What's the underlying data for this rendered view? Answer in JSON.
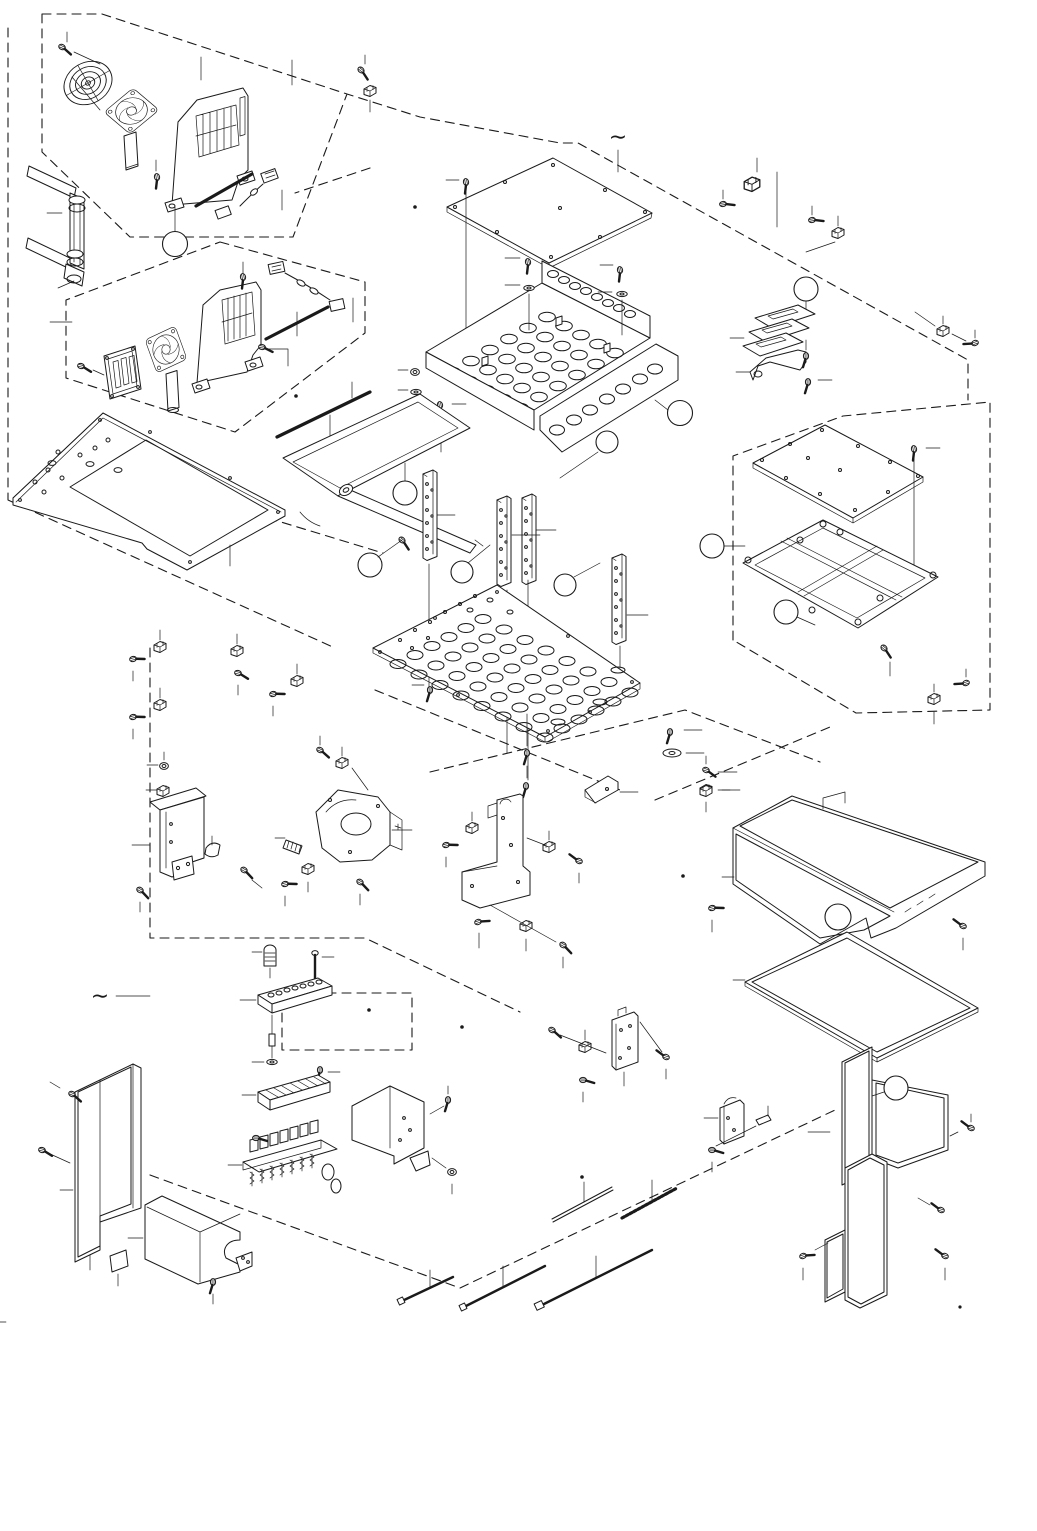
{
  "figure": {
    "type": "exploded-parts-diagram",
    "projection": "isometric",
    "background_color": "#ffffff",
    "line_color": "#1a1a1a",
    "page_width_px": 1037,
    "page_height_px": 1531
  },
  "symbols": {
    "continuation_mark": "∼",
    "continuation_mark_count": 2
  },
  "callouts": {
    "shape": "empty-circle",
    "count": 12
  },
  "assemblies": [
    {
      "name": "fan-kit-upper",
      "boundary": "dashed",
      "parts": [
        "fan-finger-guard",
        "axial-fan",
        "vented-fan-bracket",
        "connector-cable",
        "insulation-strip",
        "screws"
      ]
    },
    {
      "name": "fan-kit-lower",
      "boundary": "dashed",
      "parts": [
        "fan-guard-plate",
        "axial-fan",
        "vented-fan-bracket",
        "connector-cable",
        "insulation-strip",
        "screws"
      ]
    },
    {
      "name": "pipe-elbow-assembly",
      "parts": [
        "tubes",
        "elbow-fittings"
      ]
    },
    {
      "name": "left-perforated-plate",
      "parts": [
        "perforated-plate"
      ]
    },
    {
      "name": "top-cover-plate",
      "parts": [
        "flat-cover-plate",
        "screw"
      ]
    },
    {
      "name": "perforated-component-tray",
      "parts": [
        "perforated-tray",
        "screws",
        "washers",
        "nuts"
      ]
    },
    {
      "name": "support-posts",
      "parts": [
        "drilled-post",
        "drilled-post",
        "drilled-post",
        "drilled-post"
      ]
    },
    {
      "name": "perforated-base-plate",
      "parts": [
        "perforated-plate",
        "bolts",
        "washer"
      ]
    },
    {
      "name": "mounting-tray-bracket",
      "parts": [
        "open-tray-bracket",
        "hook"
      ]
    },
    {
      "name": "cable-clip-sets",
      "parts": [
        "wire-clip",
        "screw"
      ]
    },
    {
      "name": "lower-left-bracket-group",
      "parts": [
        "tall-bracket",
        "saddle-clamp",
        "nut",
        "screws"
      ]
    },
    {
      "name": "center-bracket-group",
      "parts": [
        "u-bracket",
        "foot-bracket",
        "angled-bracket",
        "spring-pin",
        "clips",
        "screws"
      ]
    },
    {
      "name": "busbar-plate-stack",
      "parts": [
        "slotted-plates",
        "foot-bracket",
        "screw"
      ]
    },
    {
      "name": "board-frame-assembly",
      "boundary": "dashed",
      "parts": [
        "cover-plate",
        "cross-frame",
        "standoffs",
        "screws"
      ]
    },
    {
      "name": "perforated-cover-large",
      "parts": [
        "perforated-cover",
        "screws"
      ]
    },
    {
      "name": "perforated-sheet",
      "parts": [
        "perforated-sheet"
      ]
    },
    {
      "name": "perforated-duct-tower",
      "parts": [
        "perforated-duct",
        "screws"
      ]
    },
    {
      "name": "side-perforated-panel",
      "parts": [
        "perforated-panel",
        "screws"
      ]
    },
    {
      "name": "u-cover-bracket",
      "parts": [
        "u-cover",
        "pad",
        "screw"
      ]
    },
    {
      "name": "valve-manifold-assembly",
      "boundary": "dashed",
      "parts": [
        "solenoid-valve-bank",
        "manifold-rail",
        "terminal-block",
        "silencer-cartridge",
        "long-bolt",
        "spacer",
        "washer",
        "mounting-bracket"
      ]
    },
    {
      "name": "small-plate-brackets",
      "parts": [
        "plate-bracket",
        "plate-bracket",
        "clips",
        "screws"
      ]
    },
    {
      "name": "cable-ties",
      "parts": [
        "cable-tie",
        "cable-tie",
        "cable-tie"
      ]
    },
    {
      "name": "rods-and-strips",
      "parts": [
        "rod",
        "toothed-strip"
      ]
    }
  ],
  "hardware_legend": [
    "pan-head-screw",
    "flange-bolt",
    "washer",
    "hex-nut",
    "wire-clip",
    "cable-tie"
  ]
}
